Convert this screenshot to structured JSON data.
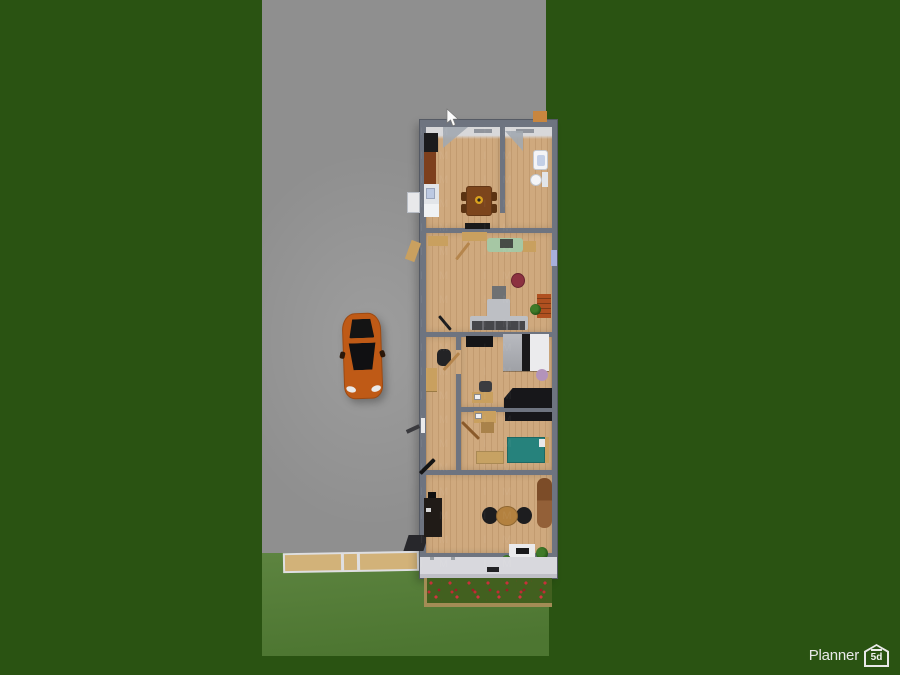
{
  "branding": {
    "logo_text": "Planner",
    "logo_badge": "5d"
  },
  "icons": {
    "cursor": "mouse-pointer",
    "logo": "house-5d-badge"
  },
  "scene": {
    "description": "Top-down 3D floor-plan render of a narrow house on a plot with gray driveway, orange car, lawn, walkway and red flower bed",
    "watermark": "IM",
    "colors": {
      "background_grass": "#2a5312",
      "lawn_light": "#55803b",
      "driveway": "#8f8f8f",
      "wall": "#6e7480",
      "floor_wood": "#cfa97e",
      "porch": "#d8d8dd",
      "car_orange": "#bf5a16",
      "sofa_green": "#a6c7a4",
      "bed_teal": "#26827c",
      "table_red": "#8c3140",
      "flower_red": "#c52b35",
      "walkway_tan": "#d2b279",
      "logo_text": "#e9e9e9"
    },
    "rooms": [
      {
        "name": "kitchen",
        "objects": [
          "stove",
          "tall-cabinet",
          "counter-sink",
          "fridge",
          "dining-table",
          "dining-chairs",
          "fruit-bowl",
          "door"
        ]
      },
      {
        "name": "bathroom",
        "objects": [
          "sink",
          "toilet",
          "door"
        ]
      },
      {
        "name": "living-room",
        "objects": [
          "sideboards",
          "green-sofa",
          "tv",
          "window",
          "round-red-table",
          "gray-table",
          "shelf-unit",
          "plant",
          "sectional-sofa",
          "media-bench",
          "doors"
        ]
      },
      {
        "name": "bedroom-1",
        "objects": [
          "wall-tv",
          "double-bed",
          "round-rug",
          "desk",
          "desk-chair",
          "laptop",
          "black-wardrobe"
        ]
      },
      {
        "name": "hallway",
        "objects": [
          "cabinet",
          "armchair",
          "door"
        ]
      },
      {
        "name": "bedroom-2",
        "objects": [
          "desk",
          "laptop",
          "wall-shelf",
          "cabinet",
          "teal-bed",
          "dresser",
          "door"
        ]
      },
      {
        "name": "office",
        "objects": [
          "dark-cabinet",
          "round-table",
          "two-chairs",
          "runner-rug",
          "console-table",
          "plants",
          "door"
        ]
      }
    ],
    "outdoor_objects": [
      "driveway",
      "orange-car",
      "walkway",
      "lawn",
      "flower-bed",
      "ac-unit",
      "chimney",
      "stoop"
    ]
  }
}
